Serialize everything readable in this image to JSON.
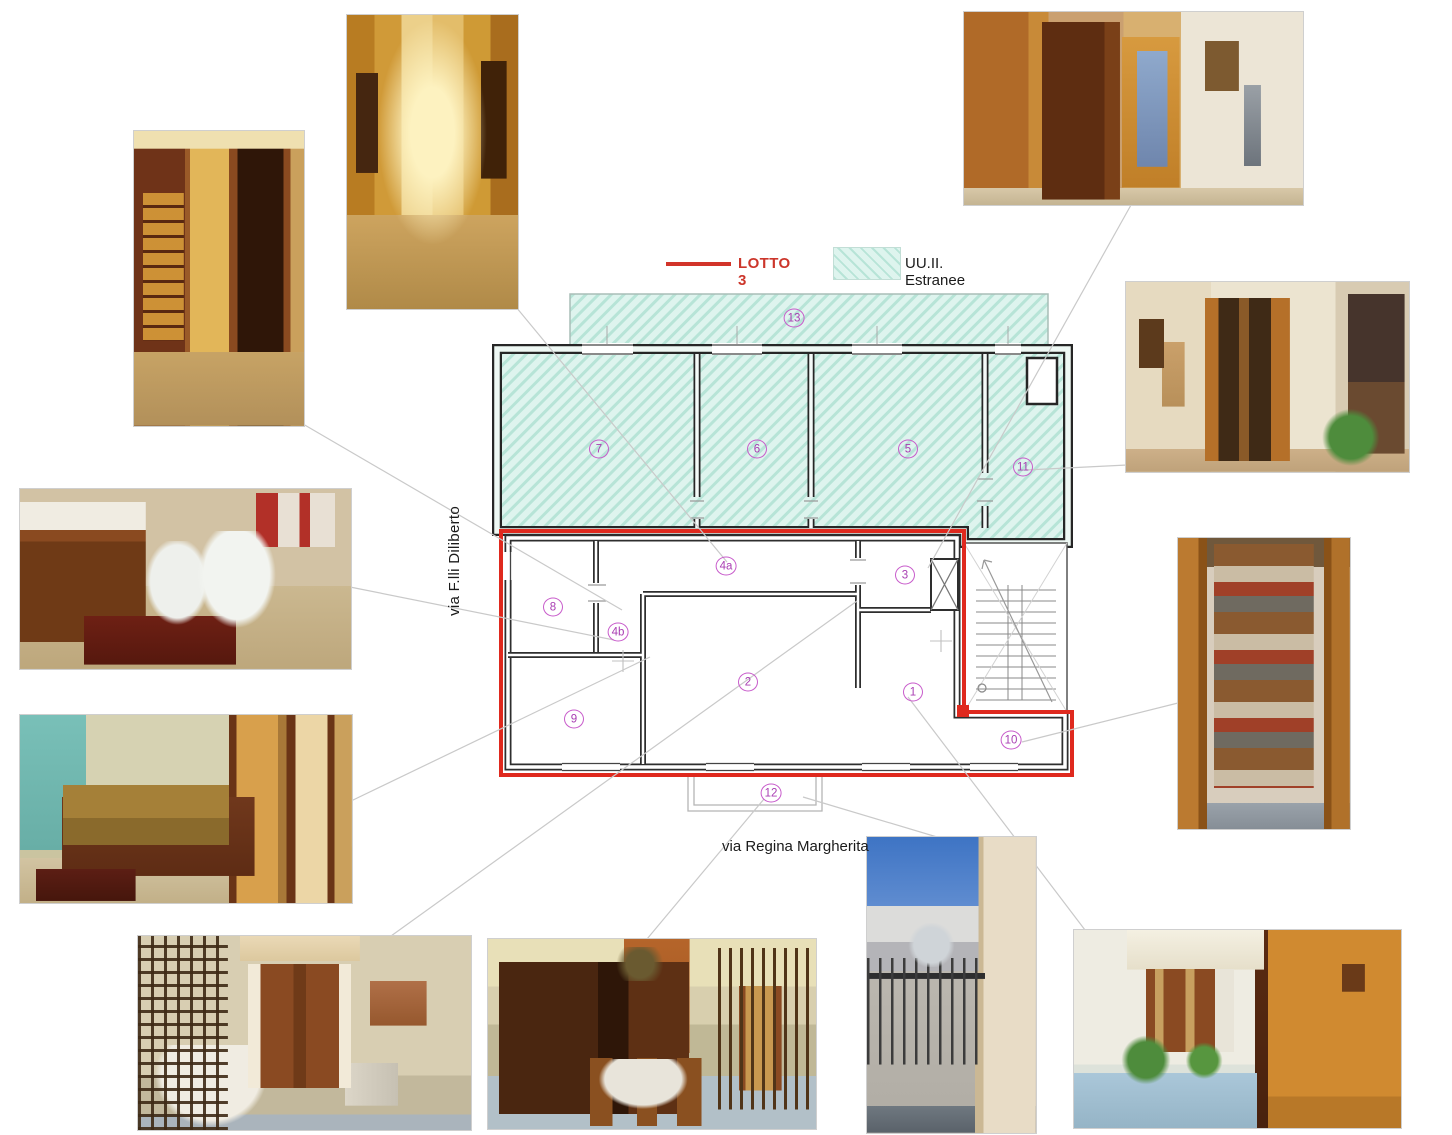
{
  "legend": {
    "lotto": {
      "label": "LOTTO 3",
      "color": "#d2342a"
    },
    "estranee": {
      "label": "UU.II. Estranee"
    }
  },
  "streets": {
    "left": "via F.lli Diliberto",
    "bottom": "via Regina Margherita"
  },
  "plan": {
    "rooms": [
      {
        "label": "1"
      },
      {
        "label": "2"
      },
      {
        "label": "3"
      },
      {
        "label": "4a"
      },
      {
        "label": "4b"
      },
      {
        "label": "5"
      },
      {
        "label": "6"
      },
      {
        "label": "7"
      },
      {
        "label": "8"
      },
      {
        "label": "9"
      },
      {
        "label": "10"
      },
      {
        "label": "11"
      },
      {
        "label": "12"
      },
      {
        "label": "13"
      }
    ],
    "colors": {
      "lotto_outline": "#df291e",
      "extraneous_fill": "#def4ee",
      "extraneous_hatch": "#b7e4d7",
      "room_number": "#b545bd",
      "walls": "#262626"
    }
  },
  "photos": [
    {
      "name": "hallway-glass-door"
    },
    {
      "name": "picture-corridor"
    },
    {
      "name": "antique-hall"
    },
    {
      "name": "entrance-open-doors"
    },
    {
      "name": "storage-closet"
    },
    {
      "name": "bathroom"
    },
    {
      "name": "bedroom"
    },
    {
      "name": "dining-room"
    },
    {
      "name": "living-dining-room"
    },
    {
      "name": "balcony-street-view"
    },
    {
      "name": "room-corner-window"
    }
  ]
}
